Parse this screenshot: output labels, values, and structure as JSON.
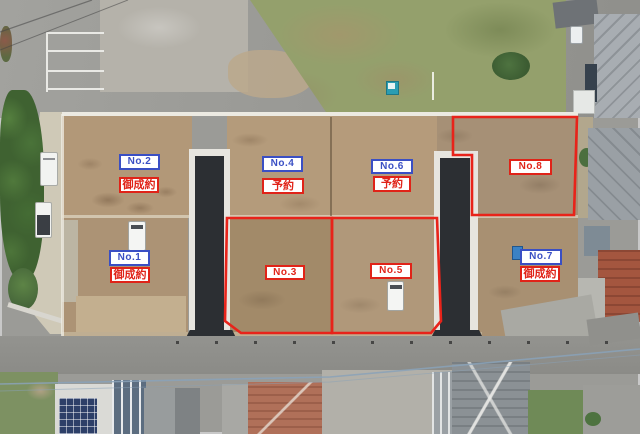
{
  "image": {
    "description_kind": "aerial-subdivision-photo",
    "rows": 2,
    "lot_count": 8
  },
  "colors": {
    "label_blue": "#3a4fc4",
    "label_red": "#e02318",
    "outline_red": "#e8231a"
  },
  "lots": [
    {
      "number": "No.1",
      "status": "御成約",
      "number_color": "blue",
      "status_color": "red",
      "red_outline": false
    },
    {
      "number": "No.2",
      "status": "御成約",
      "number_color": "blue",
      "status_color": "red",
      "red_outline": false
    },
    {
      "number": "No.3",
      "status": "",
      "number_color": "red",
      "status_color": "",
      "red_outline": true
    },
    {
      "number": "No.4",
      "status": "予約",
      "number_color": "blue",
      "status_color": "red",
      "red_outline": false
    },
    {
      "number": "No.5",
      "status": "",
      "number_color": "red",
      "status_color": "",
      "red_outline": true
    },
    {
      "number": "No.6",
      "status": "予約",
      "number_color": "blue",
      "status_color": "red",
      "red_outline": false
    },
    {
      "number": "No.7",
      "status": "御成約",
      "number_color": "blue",
      "status_color": "red",
      "red_outline": false
    },
    {
      "number": "No.8",
      "status": "",
      "number_color": "red",
      "status_color": "",
      "red_outline": true
    }
  ]
}
